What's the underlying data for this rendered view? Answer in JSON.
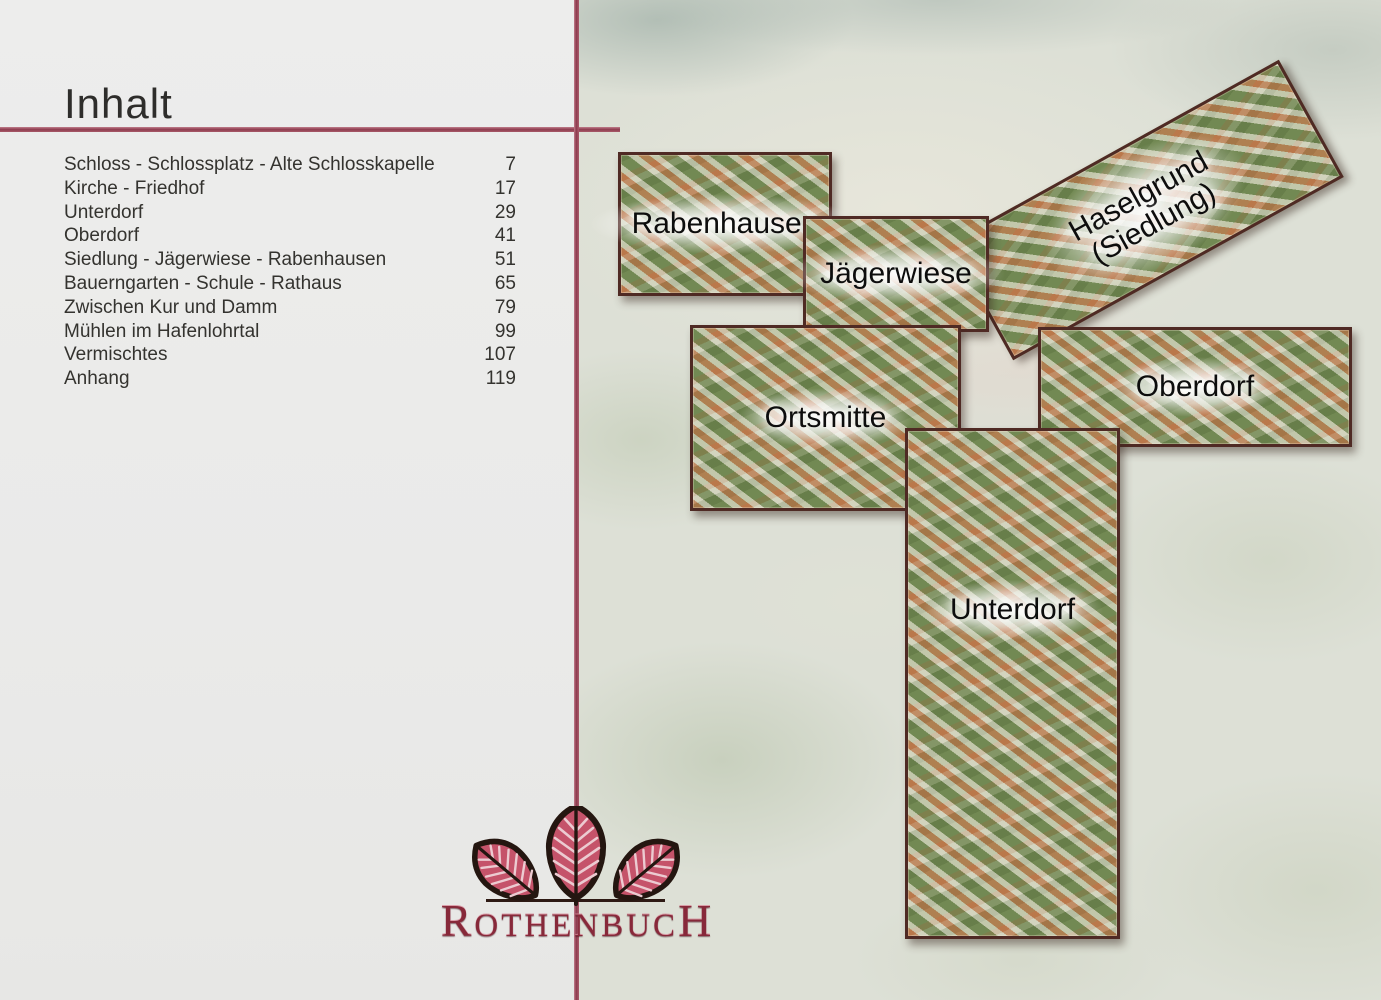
{
  "page_title": "Inhalt",
  "toc": {
    "items": [
      {
        "label": "Schloss - Schlossplatz - Alte Schlosskapelle",
        "page": "7"
      },
      {
        "label": "Kirche - Friedhof",
        "page": "17"
      },
      {
        "label": "Unterdorf",
        "page": "29"
      },
      {
        "label": "Oberdorf",
        "page": "41"
      },
      {
        "label": "Siedlung - Jägerwiese - Rabenhausen",
        "page": "51"
      },
      {
        "label": "Bauerngarten - Schule - Rathaus",
        "page": "65"
      },
      {
        "label": "Zwischen Kur und Damm",
        "page": "79"
      },
      {
        "label": "Mühlen im Hafenlohrtal",
        "page": "99"
      },
      {
        "label": "Vermischtes",
        "page": "107"
      },
      {
        "label": "Anhang",
        "page": "119"
      }
    ]
  },
  "map": {
    "regions": [
      {
        "id": "rabenhausen",
        "label": "Rabenhausen"
      },
      {
        "id": "jaegerwiese",
        "label": "Jägerwiese"
      },
      {
        "id": "haselgrund",
        "label": "Haselgrund",
        "label_line2": "(Siedlung)"
      },
      {
        "id": "oberdorf",
        "label": "Oberdorf"
      },
      {
        "id": "ortsmitte",
        "label": "Ortsmitte"
      },
      {
        "id": "unterdorf",
        "label": "Unterdorf"
      }
    ]
  },
  "logo": {
    "word_start": "R",
    "word_mid": "OTHENBUC",
    "word_end": "H"
  },
  "colors": {
    "accent_rule": "#8e3b4e",
    "region_border": "#4f2a24",
    "leaf_fill": "#c5536a"
  }
}
